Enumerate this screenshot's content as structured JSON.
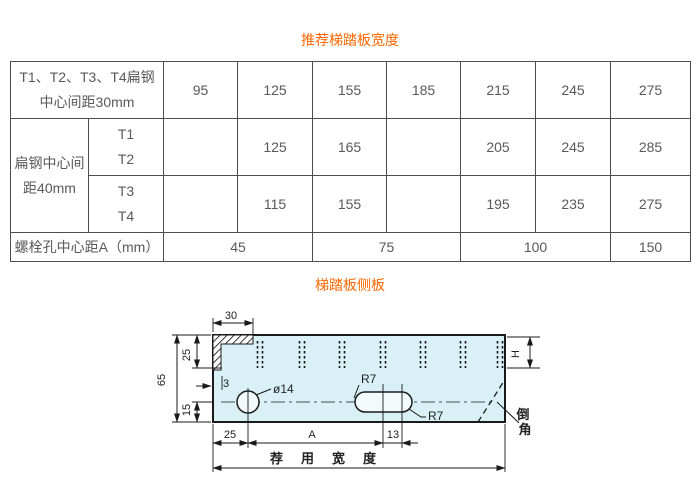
{
  "page": {
    "table_title": "推荐梯踏板宽度",
    "drawing_title": "梯踏板侧板"
  },
  "colors": {
    "title_orange": "#ff6600",
    "table_border": "#4d4d4d",
    "table_text": "#595959",
    "plate_fill": "#d9f1f6",
    "line_black": "#1a1a1a"
  },
  "table": {
    "row1": {
      "label_line1": "T1、T2、T3、T4扁钢",
      "label_line2": "中心间距30mm",
      "values": [
        "95",
        "125",
        "155",
        "185",
        "215",
        "245",
        "275"
      ]
    },
    "row2": {
      "group_label_line1": "扁钢中心间",
      "group_label_line2": "距40mm",
      "sub_line1": "T1",
      "sub_line2": "T2",
      "values": [
        "",
        "125",
        "165",
        "",
        "205",
        "245",
        "285"
      ]
    },
    "row3": {
      "sub_line1": "T3",
      "sub_line2": "T4",
      "values": [
        "",
        "115",
        "155",
        "",
        "195",
        "235",
        "275"
      ]
    },
    "row4": {
      "label": "螺栓孔中心距A（mm）",
      "values": [
        "45",
        "75",
        "100",
        "150"
      ]
    }
  },
  "drawing": {
    "dim_top_flange": "30",
    "dim_upper_left": "25",
    "dim_total_height": "65",
    "dim_lower_left": "15",
    "dim_thickness": "3",
    "hole_label": "ø14",
    "slot_r_top": "R7",
    "slot_r_bottom": "R7",
    "dim_serration_height": "H",
    "dim_bottom_left": "25",
    "dim_hole_to_slot": "A",
    "dim_slot_offset": "13",
    "chamfer_line1": "倒",
    "chamfer_line2": "角",
    "overall_width_label": "荐用宽度"
  }
}
